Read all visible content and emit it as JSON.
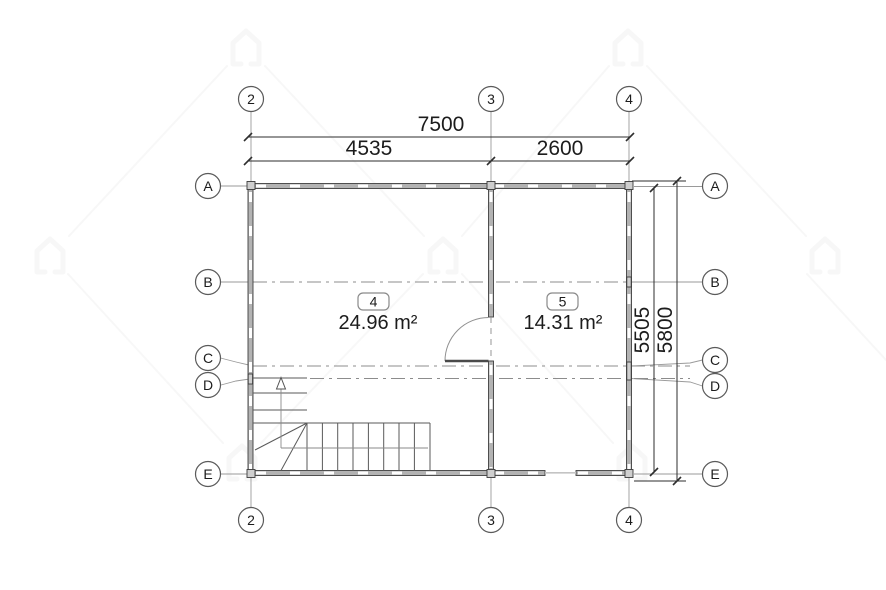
{
  "drawing": {
    "type": "floor-plan",
    "grid": {
      "cols": [
        {
          "label": "2"
        },
        {
          "label": "3"
        },
        {
          "label": "4"
        }
      ],
      "rows": [
        {
          "label": "A"
        },
        {
          "label": "B"
        },
        {
          "label": "C"
        },
        {
          "label": "D"
        },
        {
          "label": "E"
        }
      ]
    },
    "dimensions": {
      "total_width": "7500",
      "width_left": "4535",
      "width_right": "2600",
      "height_inner": "5505",
      "height_total": "5800"
    },
    "rooms": [
      {
        "number": "4",
        "area": "24.96 m²"
      },
      {
        "number": "5",
        "area": "14.31 m²"
      }
    ],
    "colors": {
      "line": "#2e2e2e",
      "wall_fill": "#b3b3b3",
      "wall_edge": "#404040",
      "grid_line": "#9a9a9a",
      "text": "#1c1c1c",
      "watermark": "#7a7a7a"
    }
  }
}
